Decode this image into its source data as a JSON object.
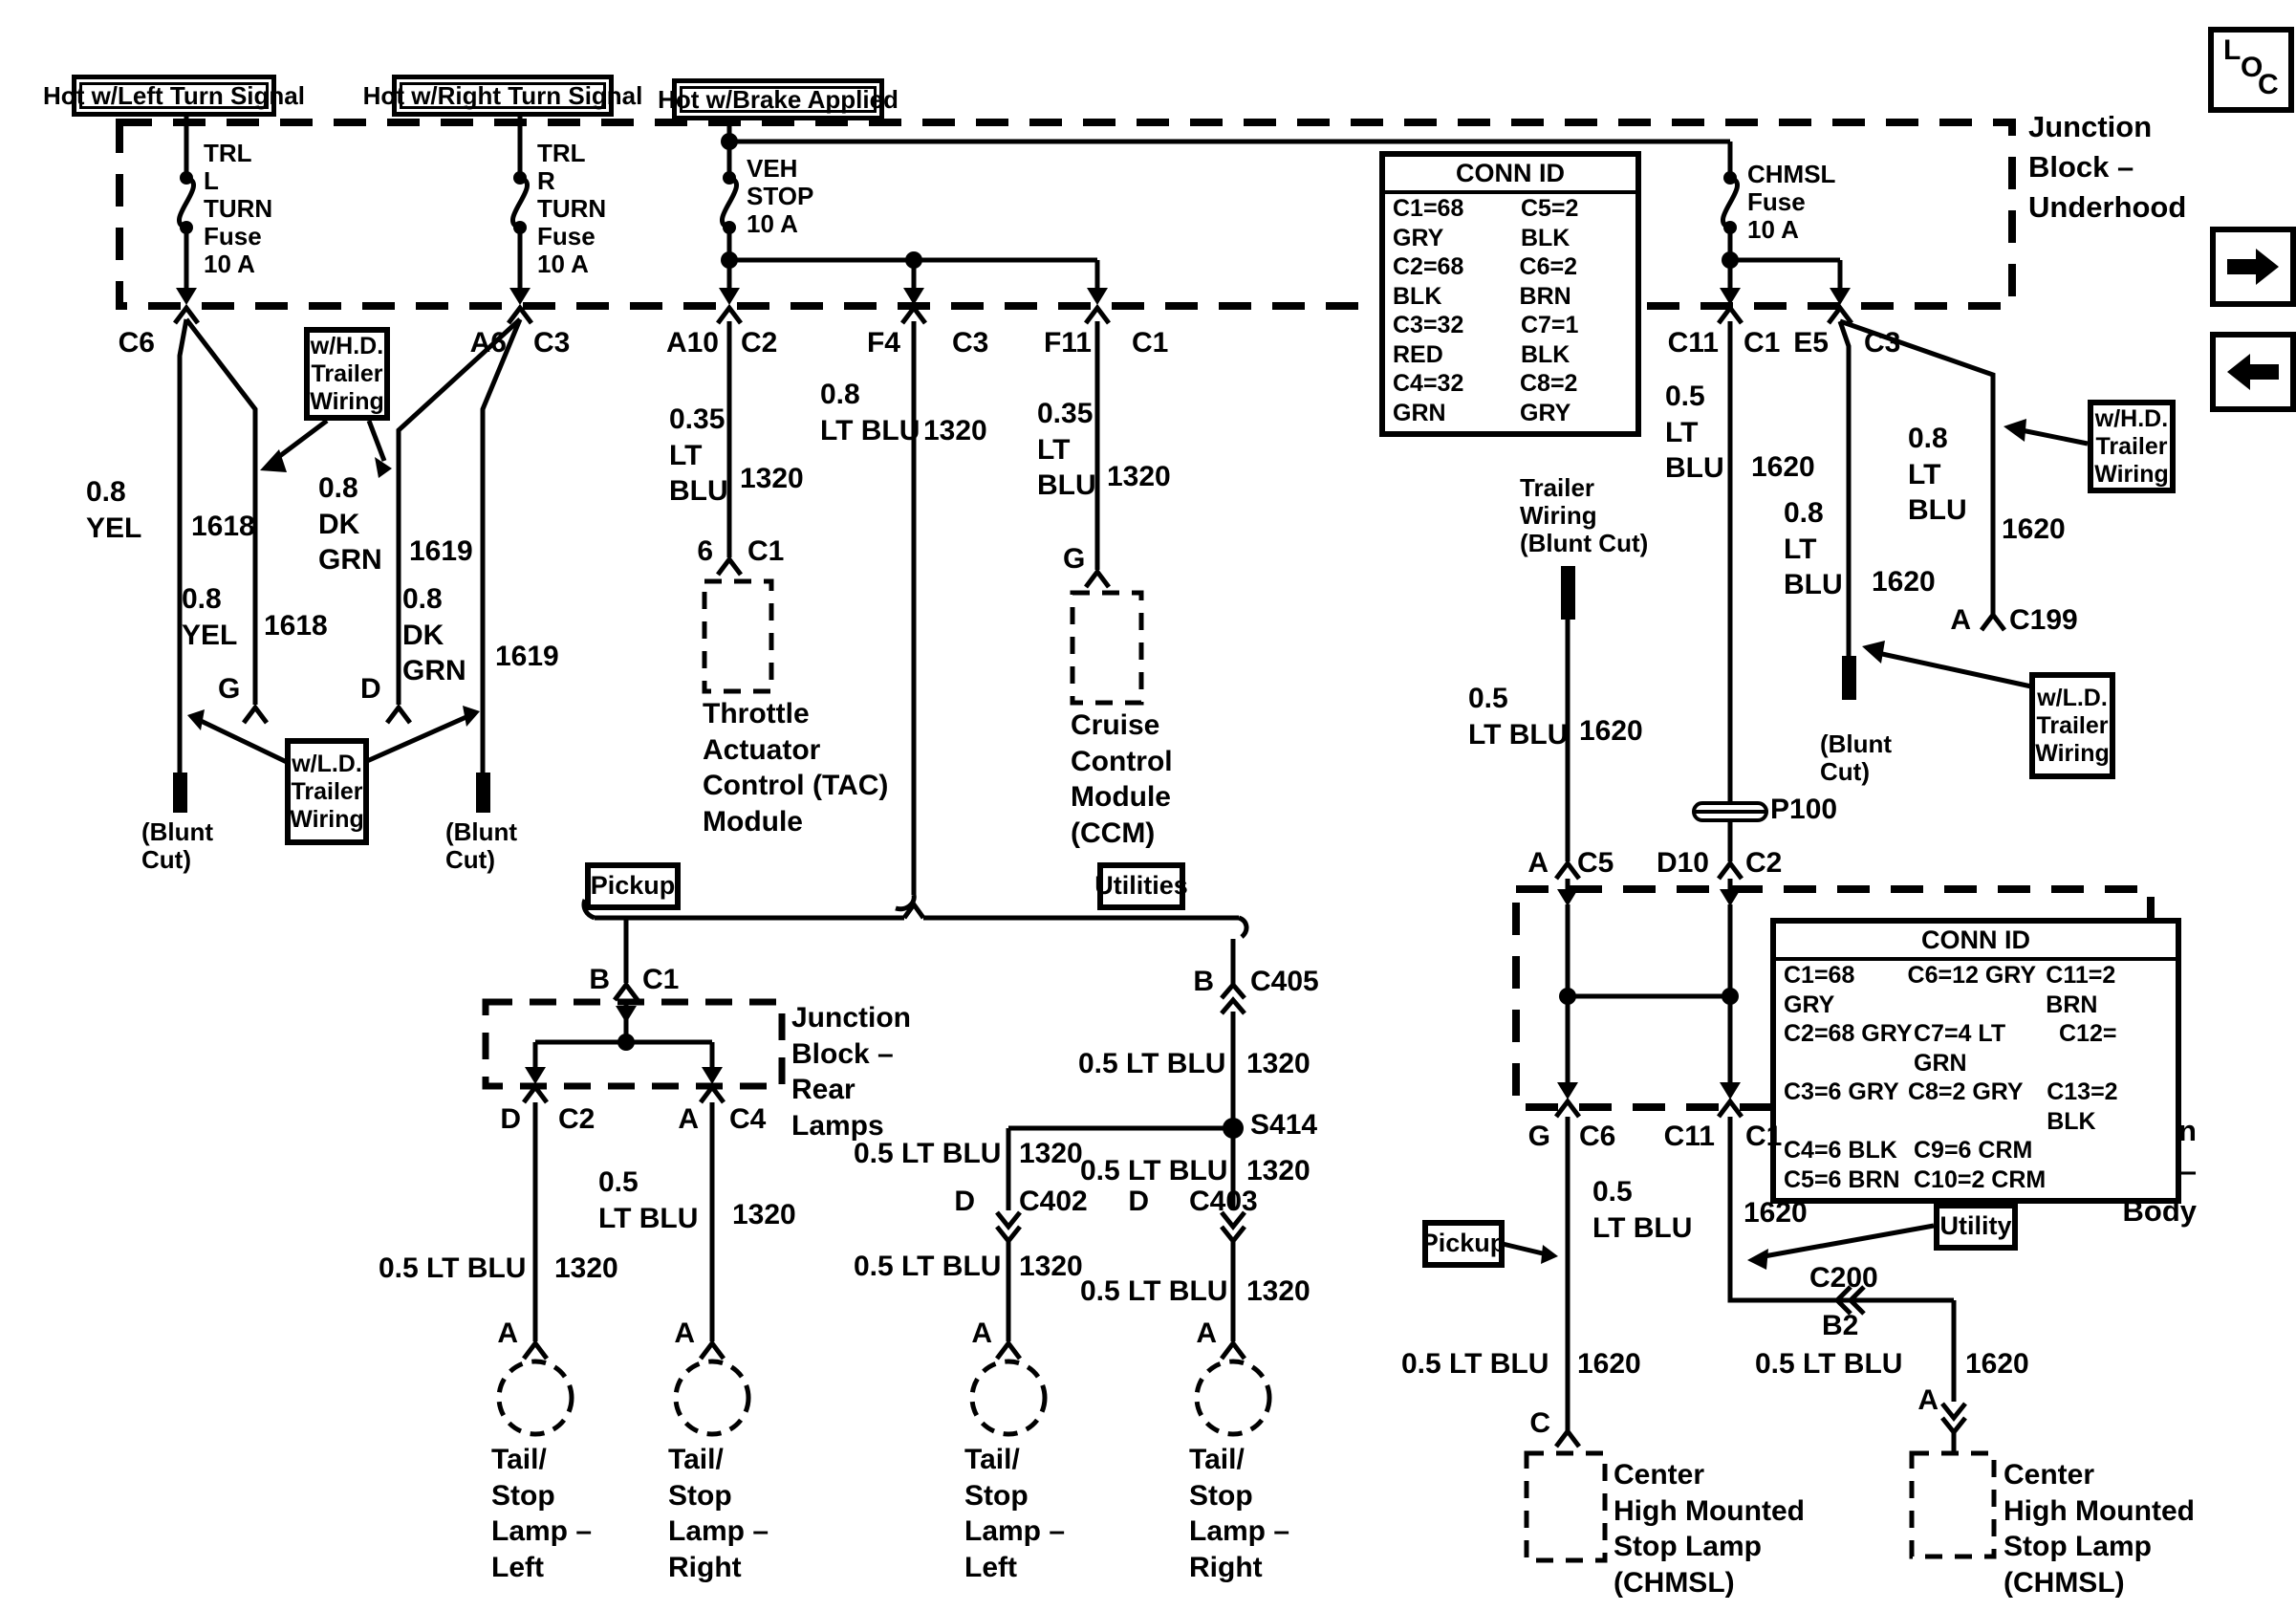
{
  "badge": {
    "l": "L",
    "o": "O",
    "c": "C"
  },
  "power_labels": [
    "Hot w/Left Turn Signal",
    "Hot w/Right Turn Signal",
    "Hot w/Brake Applied"
  ],
  "fuses": {
    "trl_l": "TRL\nL\nTURN\nFuse\n10 A",
    "trl_r": "TRL\nR\nTURN\nFuse\n10 A",
    "veh_stop": "VEH\nSTOP\n10 A",
    "chmsl": "CHMSL\nFuse\n10 A"
  },
  "junction_blocks": {
    "underhood": "Junction\nBlock –\nUnderhood",
    "rear_lamps": "Junction\nBlock –\nRear\nLamps",
    "body": "Junction\nBlock –\nBody"
  },
  "conn_id_underhood": {
    "title": "CONN ID",
    "rows": [
      [
        "C1=68 GRY",
        "C5=2 BLK"
      ],
      [
        "C2=68 BLK",
        "C6=2 BRN"
      ],
      [
        "C3=32 RED",
        "C7=1 BLK"
      ],
      [
        "C4=32 GRN",
        "C8=2 GRY"
      ]
    ]
  },
  "conn_id_body": {
    "title": "CONN ID",
    "rows": [
      [
        "C1=68 GRY",
        "C6=12 GRY",
        "C11=2 BRN"
      ],
      [
        "C2=68 GRY",
        "C7=4 LT GRN",
        "C12="
      ],
      [
        "C3=6 GRY",
        "C8=2 GRY",
        "C13=2 BLK"
      ],
      [
        "C4=6 BLK",
        "C9=6 CRM",
        ""
      ],
      [
        "C5=6 BRN",
        "C10=2 CRM",
        ""
      ]
    ]
  },
  "pins": {
    "a": "A",
    "b": "B",
    "c": "C",
    "d": "D",
    "g": "G",
    "six": "6",
    "a6": "A6",
    "a10": "A10",
    "f4": "F4",
    "f11": "F11",
    "e5": "E5",
    "d10": "D10",
    "b2": "B2",
    "c11": "C11"
  },
  "connectors": {
    "c1": "C1",
    "c2": "C2",
    "c3": "C3",
    "c4": "C4",
    "c5": "C5",
    "c6": "C6",
    "c199": "C199",
    "c200": "C200",
    "c402": "C402",
    "c403": "C403",
    "c405": "C405",
    "s414": "S414",
    "p100": "P100"
  },
  "wire_labels": {
    "yel": "0.8\nYEL",
    "dk_grn": "0.8\nDK\nGRN",
    "lt_blu_035": "0.35\nLT\nBLU",
    "lt_blu_08_2l": "0.8\nLT BLU",
    "lt_blu_08_3l": "0.8\nLT\nBLU",
    "lt_blu_05_1l": "0.5 LT BLU",
    "lt_blu_05_2l": "0.5\nLT BLU",
    "lt_blu_05_3l": "0.5\nLT\nBLU",
    "ckt1618": "1618",
    "ckt1619": "1619",
    "ckt1320": "1320",
    "ckt1620": "1620"
  },
  "components": {
    "tac": "Throttle\nActuator\nControl (TAC)\nModule",
    "ccm": "Cruise\nControl\nModule\n(CCM)",
    "tail_left": "Tail/\nStop\nLamp –\nLeft",
    "tail_right": "Tail/\nStop\nLamp –\nRight",
    "chmsl": "Center\nHigh Mounted\nStop Lamp\n(CHMSL)"
  },
  "callouts": {
    "whd": "w/H.D.\nTrailer\nWiring",
    "wld": "w/L.D.\nTrailer\nWiring",
    "pickup": "Pickup",
    "utilities": "Utilities",
    "utility": "Utility",
    "trailer_blunt": "Trailer\nWiring\n(Blunt Cut)",
    "blunt_cut": "(Blunt\nCut)"
  }
}
